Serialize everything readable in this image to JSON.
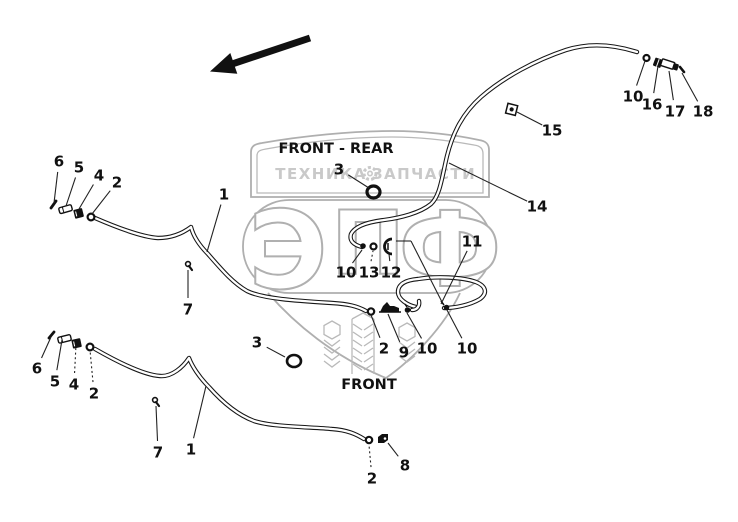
{
  "diagram": {
    "annotations": {
      "front_rear": "FRONT - REAR",
      "front": "FRONT"
    },
    "watermark": {
      "word_left": "ТЕХНИКА",
      "word_right": "ЗАПЧАСТИ",
      "letters": [
        "Э",
        "П",
        "Ф"
      ],
      "gear_icon": "gear",
      "color": "#afafaf",
      "text_color": "#c9c9c9"
    },
    "colors": {
      "line": "#161616",
      "background": "#ffffff"
    },
    "direction_arrow": "points-lower-left",
    "callouts": [
      {
        "n": "6",
        "x": 59,
        "y": 161,
        "tx": 54,
        "ty": 203
      },
      {
        "n": "5",
        "x": 79,
        "y": 167,
        "tx": 66,
        "ty": 206
      },
      {
        "n": "4",
        "x": 99,
        "y": 175,
        "tx": 79,
        "ty": 209
      },
      {
        "n": "2",
        "x": 117,
        "y": 182,
        "tx": 92,
        "ty": 214
      },
      {
        "n": "1",
        "x": 224,
        "y": 194,
        "tx": 207,
        "ty": 252
      },
      {
        "n": "7",
        "x": 188,
        "y": 309,
        "tx": 188,
        "ty": 270
      },
      {
        "n": "3",
        "x": 339,
        "y": 169,
        "tx": 369,
        "ty": 188
      },
      {
        "n": "10",
        "x": 346,
        "y": 272,
        "tx": 362,
        "ty": 250
      },
      {
        "n": "13",
        "x": 369,
        "y": 272,
        "tx": 373,
        "ty": 251,
        "dashed": true
      },
      {
        "n": "12",
        "x": 391,
        "y": 272,
        "tx": 389,
        "ty": 254
      },
      {
        "n": "11",
        "x": 472,
        "y": 241,
        "tx": 441,
        "ty": 304
      },
      {
        "n": "14",
        "x": 537,
        "y": 206,
        "tx": 449,
        "ty": 163
      },
      {
        "n": "15",
        "x": 552,
        "y": 130,
        "tx": 517,
        "ty": 112
      },
      {
        "n": "10",
        "x": 633,
        "y": 96,
        "tx": 645,
        "ty": 61
      },
      {
        "n": "16",
        "x": 652,
        "y": 104,
        "tx": 658,
        "ty": 66
      },
      {
        "n": "17",
        "x": 675,
        "y": 111,
        "tx": 669,
        "ty": 71
      },
      {
        "n": "18",
        "x": 703,
        "y": 111,
        "tx": 682,
        "ty": 73
      },
      {
        "n": "2",
        "x": 384,
        "y": 348,
        "tx": 371,
        "ty": 315
      },
      {
        "n": "9",
        "x": 404,
        "y": 352,
        "tx": 388,
        "ty": 314
      },
      {
        "n": "10",
        "x": 427,
        "y": 348,
        "tx": 407,
        "ty": 313
      },
      {
        "n": "10",
        "x": 467,
        "y": 348,
        "tx": 447,
        "ty": 310
      },
      {
        "n": "3",
        "x": 257,
        "y": 342,
        "tx": 285,
        "ty": 357
      },
      {
        "n": "6",
        "x": 37,
        "y": 368,
        "tx": 51,
        "ty": 337
      },
      {
        "n": "5",
        "x": 55,
        "y": 381,
        "tx": 62,
        "ty": 340
      },
      {
        "n": "4",
        "x": 74,
        "y": 384,
        "tx": 76,
        "ty": 345,
        "dashed": true
      },
      {
        "n": "2",
        "x": 94,
        "y": 393,
        "tx": 90,
        "ty": 350,
        "dashed": true
      },
      {
        "n": "7",
        "x": 158,
        "y": 452,
        "tx": 156,
        "ty": 406
      },
      {
        "n": "1",
        "x": 191,
        "y": 449,
        "tx": 206,
        "ty": 386
      },
      {
        "n": "2",
        "x": 372,
        "y": 478,
        "tx": 369,
        "ty": 445,
        "dashed": true
      },
      {
        "n": "8",
        "x": 405,
        "y": 465,
        "tx": 388,
        "ty": 443
      }
    ]
  }
}
